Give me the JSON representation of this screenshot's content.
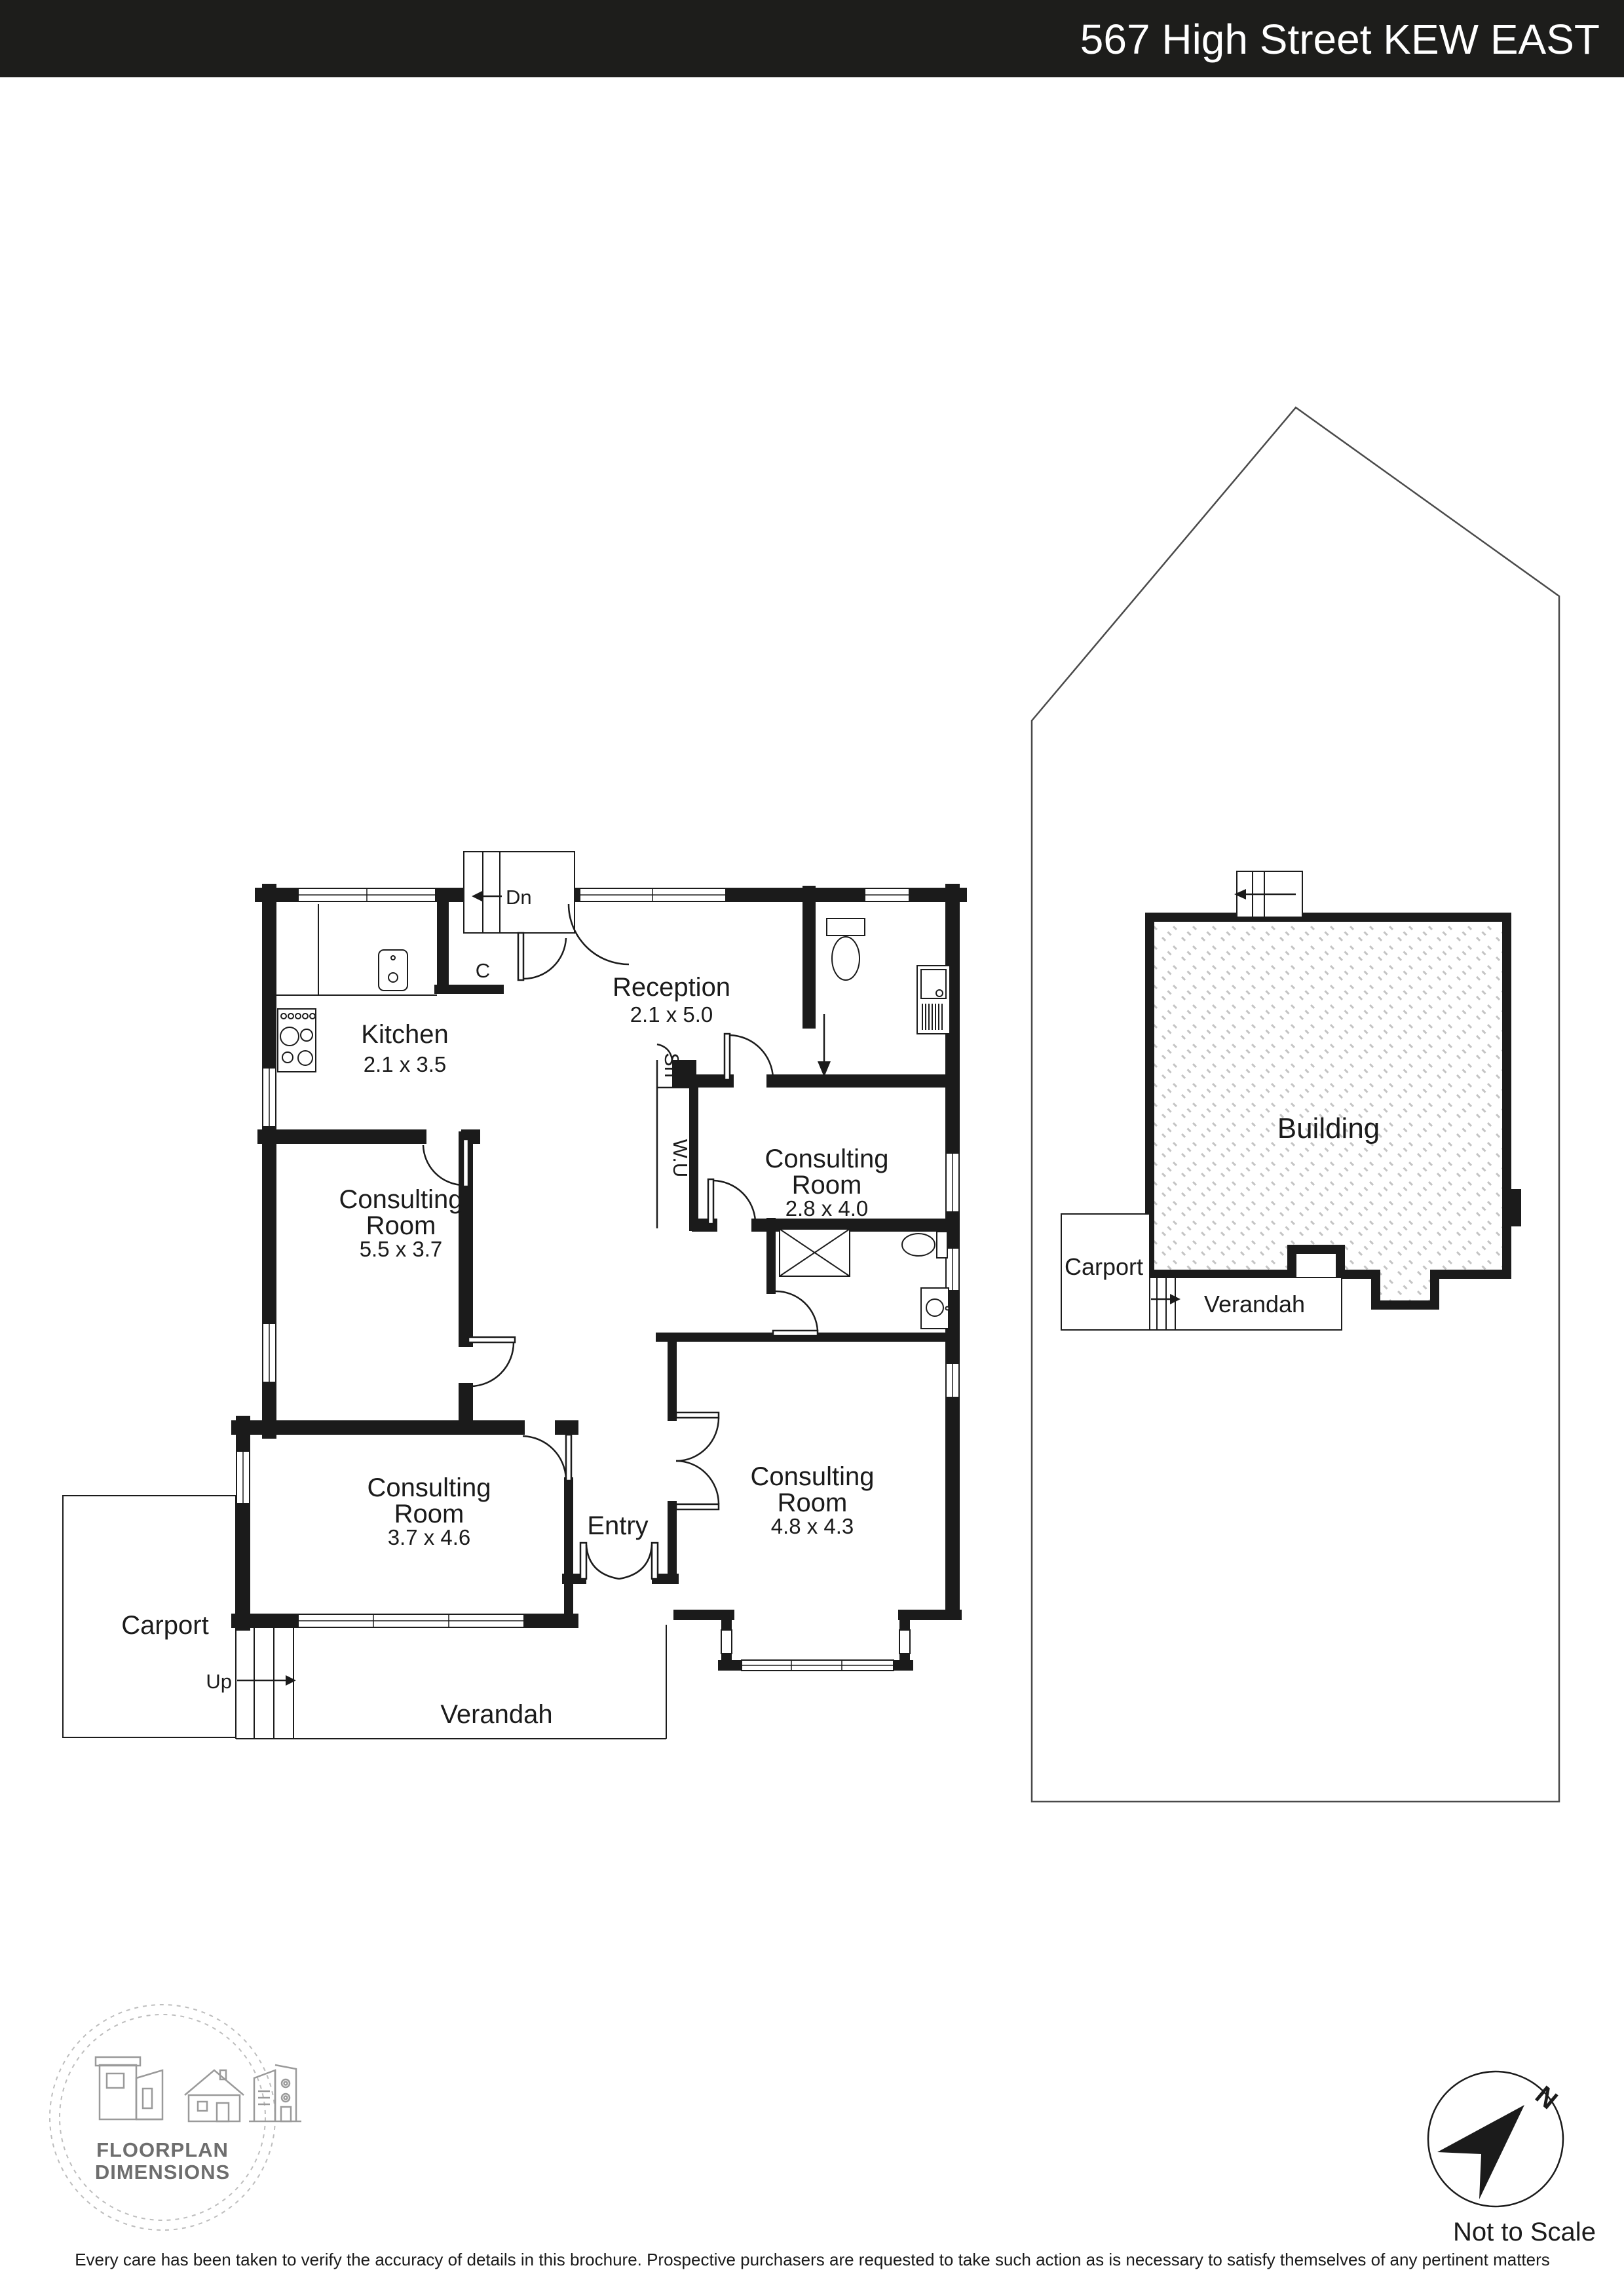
{
  "header": {
    "title": "567 High Street KEW EAST",
    "bg_color": "#1d1d1b",
    "text_color": "#ffffff"
  },
  "plan": {
    "labels": {
      "kitchen": {
        "name": "Kitchen",
        "dims": "2.1 x 3.5"
      },
      "reception": {
        "name": "Reception",
        "dims": "2.1 x 5.0"
      },
      "consulting_a": {
        "name1": "Consulting",
        "name2": "Room",
        "dims": "2.8 x 4.0"
      },
      "consulting_b": {
        "name1": "Consulting",
        "name2": "Room",
        "dims": "5.5 x 3.7"
      },
      "consulting_c": {
        "name1": "Consulting",
        "name2": "Room",
        "dims": "3.7 x 4.6"
      },
      "consulting_d": {
        "name1": "Consulting",
        "name2": "Room",
        "dims": "4.8 x 4.3"
      },
      "entry": "Entry",
      "verandah": "Verandah",
      "carport": "Carport",
      "stairs_down": "Dn",
      "stairs_up": "Up",
      "closet": "C",
      "shower": "Sh",
      "utility": "W.U"
    },
    "rear_property": {
      "building": "Building",
      "verandah": "Verandah",
      "carport": "Carport"
    },
    "compass": {
      "north": "N",
      "note": "Not to Scale"
    },
    "logo": {
      "line1": "FLOORPLAN",
      "line2": "DIMENSIONS"
    },
    "disclaimer": "Every care has been taken to verify the accuracy of details in this brochure. Prospective purchasers are requested to take such action as is necessary to satisfy themselves of any pertinent matters",
    "wall_color": "#1b1b1b",
    "hatch_color": "#c4c4c4",
    "boundary_color": "#4a4a4a"
  }
}
